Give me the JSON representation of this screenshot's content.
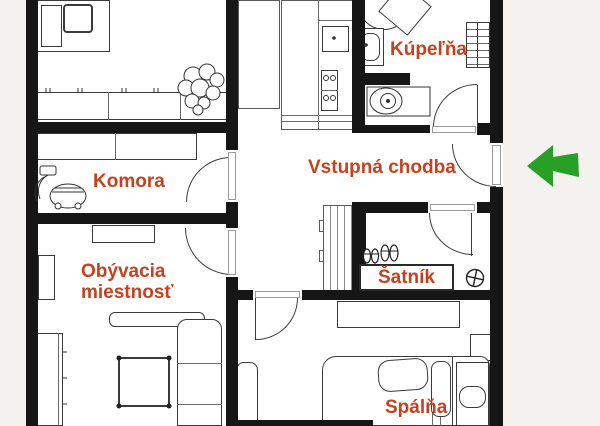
{
  "floorplan": {
    "background_color": "#f4f2ee",
    "floor_color": "#ffffff",
    "wall_color": "#161616",
    "label_color": "#c6421e",
    "rooms": [
      {
        "id": "kupelna",
        "label": "Kúpeľňa"
      },
      {
        "id": "vstupna-chodba",
        "label": "Vstupná chodba"
      },
      {
        "id": "komora",
        "label": "Komora"
      },
      {
        "id": "obyvacia-miestnost",
        "label": "Obývacia miestnosť",
        "label_line1": "Obývacia",
        "label_line2": "miestnosť"
      },
      {
        "id": "satnik",
        "label": "Šatník"
      },
      {
        "id": "spalna",
        "label": "Spálňa"
      }
    ],
    "entrance": {
      "icon": "arrow-left-icon",
      "color": "#28a028"
    }
  }
}
